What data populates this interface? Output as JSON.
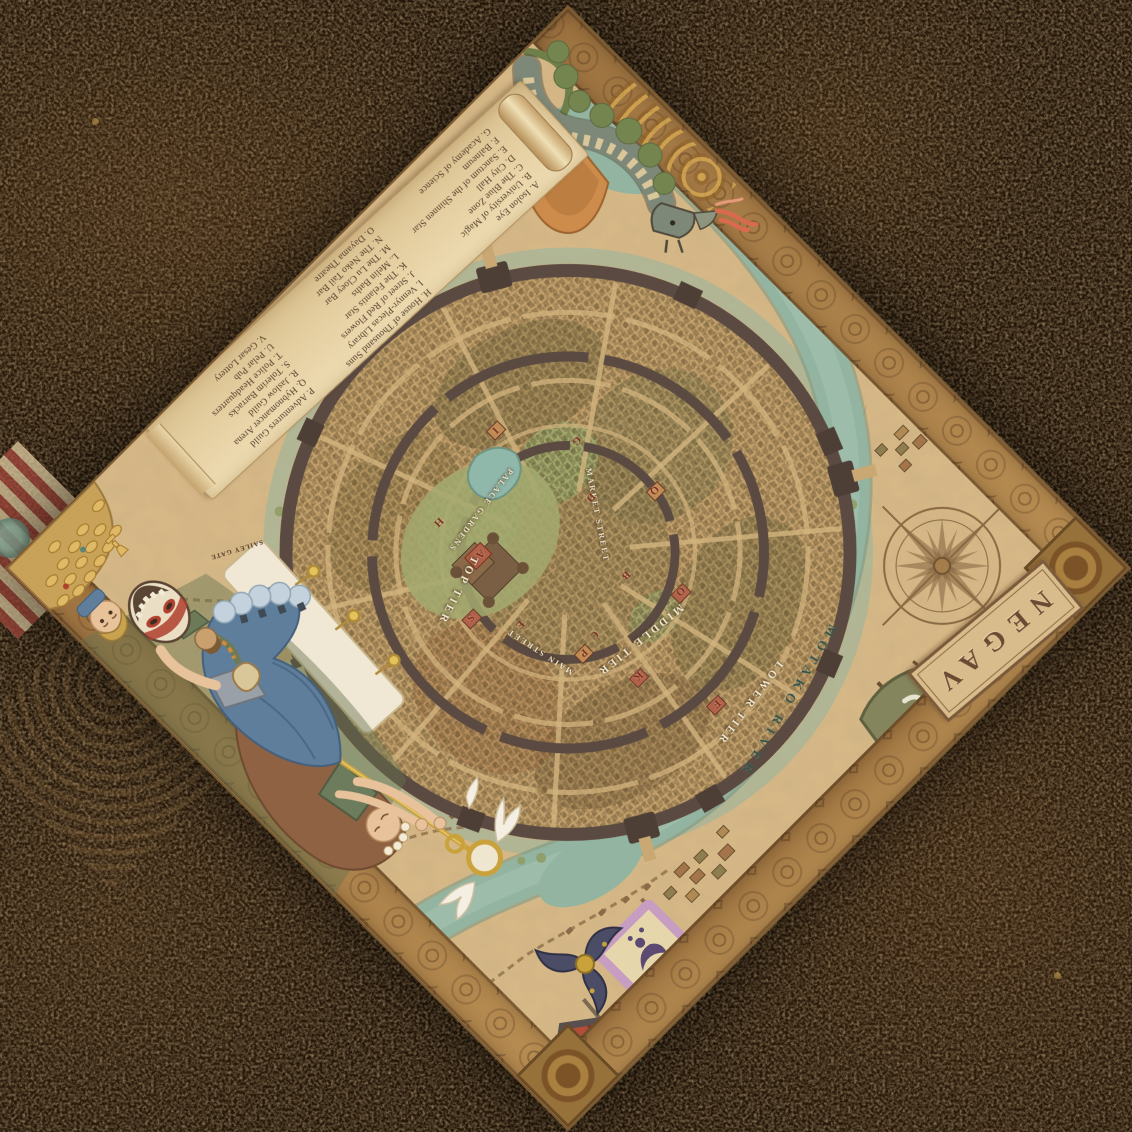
{
  "title": "NEGAV",
  "map_labels": {
    "river": "MOTAKO RIVER",
    "top_tier": "TOP TIER",
    "middle_tier": "MIDDLE TIER",
    "lower_tier": "LOWER TIER",
    "palace_gardens": "PALACE GARDENS",
    "main_street": "MAIN STREET",
    "market_street": "MARKET STREET",
    "gate": "SAILEY GATE"
  },
  "legend": {
    "column_a": [
      "A. Isolon Eye",
      "B. University of Magic",
      "C. The Blue Zone",
      "D. City Hall",
      "E. Sanctum of the Shinnen Star",
      "F. Balneum",
      "G. Academy of Science"
    ],
    "column_b": [
      "H. House of Thousand Suns",
      "I. Vennyr-Plecas Library",
      "J. Street of Red Flowers",
      "K. The Felantis Star",
      "L. Melin Baths",
      "M. The Lu Cloey Bar",
      "N. The Neko Tail Bar",
      "O. Dayama Theatre"
    ],
    "column_c": [
      "P. Adventurers Guild",
      "Q. Hybnomancer Arena",
      "R. Jaslow Guild",
      "S. Tolerim Barracks",
      "T. Police Headquarters",
      "U. Pelar Pub",
      "V. Gesar Lottery"
    ]
  },
  "map_markers": [
    {
      "letter": "A",
      "x": 448,
      "y": 468
    },
    {
      "letter": "B",
      "x": 360,
      "y": 350
    },
    {
      "letter": "C",
      "x": 425,
      "y": 330
    },
    {
      "letter": "D",
      "x": 330,
      "y": 430
    },
    {
      "letter": "E",
      "x": 470,
      "y": 390
    },
    {
      "letter": "F",
      "x": 387,
      "y": 195
    },
    {
      "letter": "G",
      "x": 300,
      "y": 480
    },
    {
      "letter": "H",
      "x": 455,
      "y": 520
    },
    {
      "letter": "I",
      "x": 350,
      "y": 545
    },
    {
      "letter": "K",
      "x": 423,
      "y": 270
    },
    {
      "letter": "O",
      "x": 333,
      "y": 300
    },
    {
      "letter": "P",
      "x": 445,
      "y": 325
    },
    {
      "letter": "Q",
      "x": 280,
      "y": 390
    },
    {
      "letter": "S",
      "x": 500,
      "y": 430
    }
  ],
  "icons": [
    "compass-rose-icon",
    "dragon-illustration",
    "lotus-flower-icon",
    "winged-lorgnette-icon",
    "oni-mask-icon",
    "goblin-figure",
    "blond-man-figure",
    "maid-figure",
    "treasure-pile",
    "shuriken-emblem-icon",
    "crescent-banner-icon",
    "urn-banner-icon",
    "spiral-banner-icon",
    "legend-scroll",
    "pin-banner"
  ],
  "colors": {
    "table_background": "#241608",
    "parchment": "#d6b887",
    "river": "#93b4a0",
    "city_wall": "#5a4a41",
    "carved_border": "#b0854e",
    "marker_red": "#7e2f1f",
    "title_brown": "#6b4a33",
    "skirt_blue": "#5e7e9c",
    "dragon_wing_orange": "#cd8c4c",
    "gold": "#c9a23c"
  }
}
